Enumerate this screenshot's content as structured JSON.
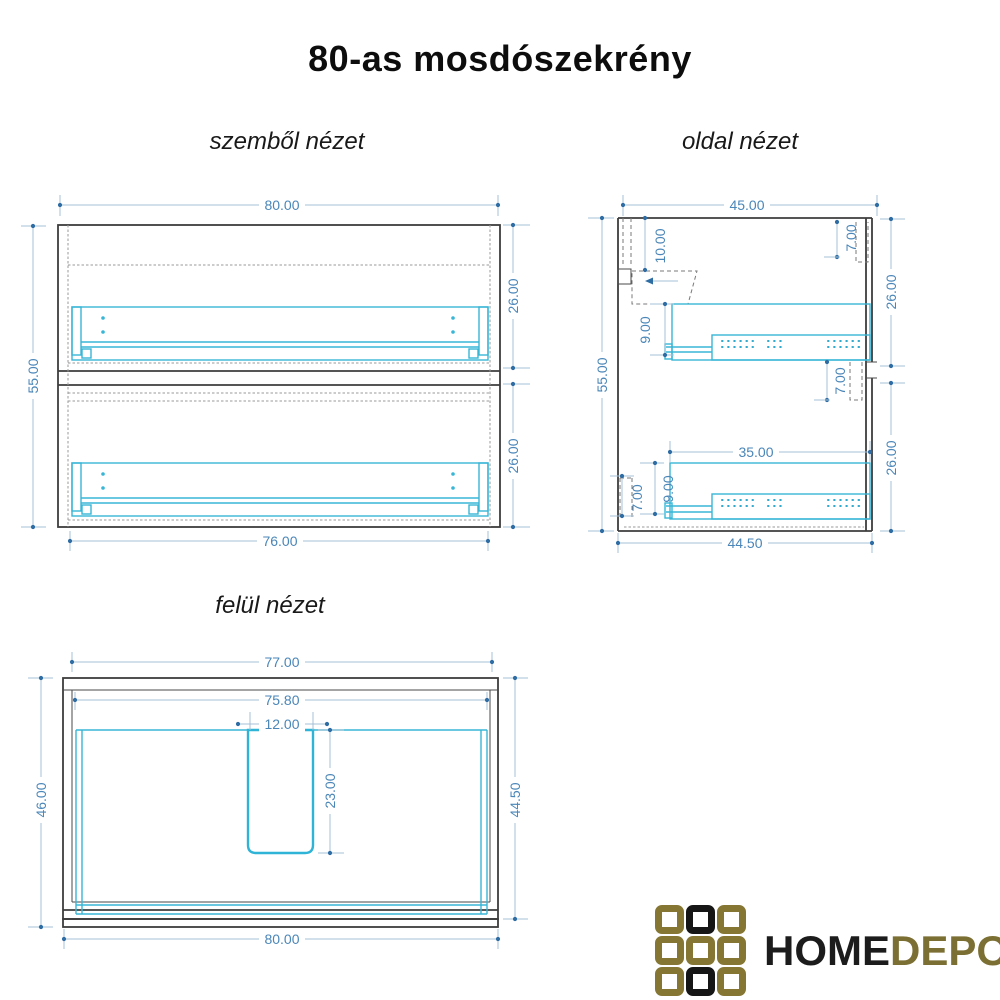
{
  "title": "80-as mosdószekrény",
  "front_view": {
    "label": "szemből nézet",
    "dims": {
      "width_top": "80.00",
      "height_left": "55.00",
      "upper_section_height": "26.00",
      "lower_section_height": "26.00",
      "width_bottom": "76.00"
    }
  },
  "side_view": {
    "label": "oldal nézet",
    "dims": {
      "depth_top": "45.00",
      "height_left": "55.00",
      "back_bracket_offset": "10.00",
      "front_top_offset": "7.00",
      "upper_section_height": "26.00",
      "upper_rail_offset": "9.00",
      "middle_front_offset": "7.00",
      "rail_length": "35.00",
      "lower_rail_offset": "9.00",
      "bottom_back_offset": "7.00",
      "lower_section_height": "26.00",
      "depth_bottom": "44.50"
    }
  },
  "top_view": {
    "label": "felül nézet",
    "dims": {
      "width_top": "77.00",
      "inner_width": "75.80",
      "cutout_width": "12.00",
      "cutout_depth": "23.00",
      "depth_left": "46.00",
      "depth_right": "44.50",
      "width_bottom": "80.00"
    }
  },
  "logo": {
    "part1": "HOME",
    "part2": "DEPO",
    "grid_pattern": [
      [
        "gold",
        "black",
        "gold"
      ],
      [
        "gold",
        "gold",
        "gold"
      ],
      [
        "gold",
        "black",
        "gold"
      ]
    ]
  },
  "colors": {
    "dim_text": "#4a86b8",
    "dim_line": "#a3c0d6",
    "dim_dot": "#2e6da4",
    "outline_dark": "#3d3d3d",
    "accent_cyan": "#38b6d6",
    "dotted_gray": "#9a9a9a",
    "logo_gold": "#857634",
    "logo_black": "#161616"
  }
}
